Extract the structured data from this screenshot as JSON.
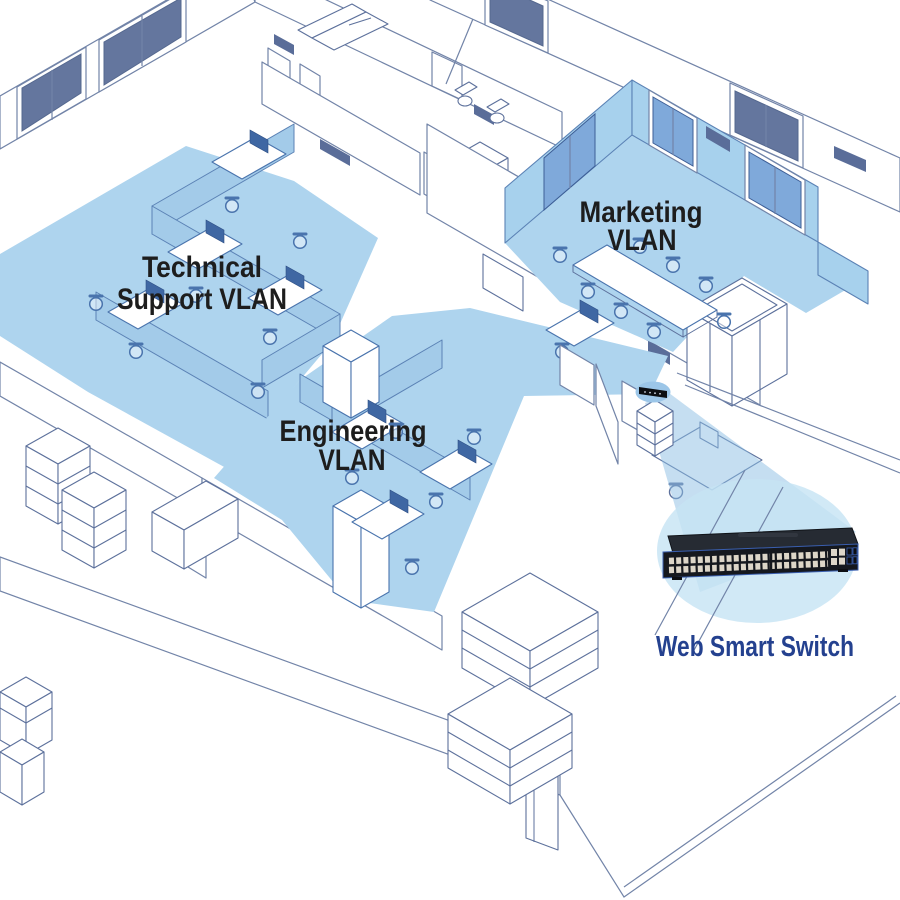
{
  "colors": {
    "vlan_fill": "#aed4ee",
    "vlan_label": "#1d1d1d",
    "callout_label": "#24418f",
    "ellipse_fill": "rgba(197,227,244,0.8)",
    "beam_fill": "rgba(140,190,228,0.5)",
    "switch_body": "#15181e"
  },
  "vlans": {
    "technical_support": {
      "line1": "Technical",
      "line2": "Support VLAN"
    },
    "engineering": {
      "line1": "Engineering",
      "line2": "VLAN"
    },
    "marketing": {
      "line1": "Marketing",
      "line2": "VLAN"
    }
  },
  "callout": {
    "label": "Web Smart Switch"
  }
}
